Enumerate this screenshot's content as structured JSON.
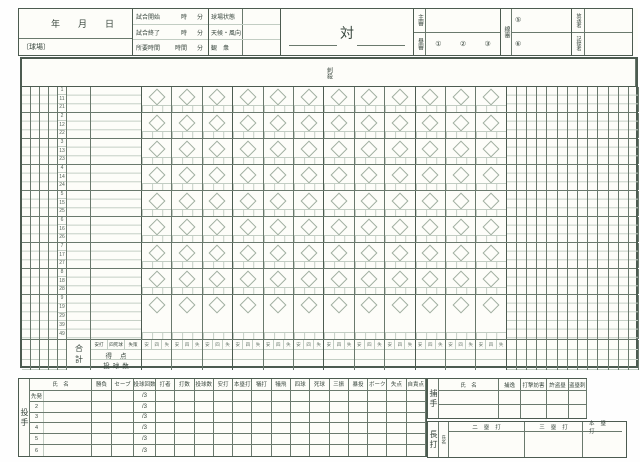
{
  "colors": {
    "line": "#6a796d",
    "line_heavy": "#4c5b50",
    "line_light": "#c2cdc3",
    "text": "#39473e",
    "paper": "#fdfdf9"
  },
  "header": {
    "date": {
      "year": "年",
      "month": "月",
      "day": "日"
    },
    "stadium_label": "〔球場〕",
    "time_rows": [
      {
        "label": "試合開始",
        "u1": "時",
        "u2": "分"
      },
      {
        "label": "試合終了",
        "u1": "時",
        "u2": "分"
      },
      {
        "label": "所要時間",
        "u1": "時間",
        "u2": "分"
      }
    ],
    "condition_rows": [
      {
        "label": "球場状態"
      },
      {
        "label": "天候・風向"
      },
      {
        "label": "観　衆"
      }
    ],
    "vs": "対",
    "umpires": {
      "chief_label": "主審",
      "base_label": "塁審",
      "base_nums": [
        "①",
        "②",
        "③"
      ],
      "line_label": "線審",
      "line_nums": [
        "⑤",
        "⑥"
      ]
    },
    "recorders": [
      {
        "label": "放送者"
      },
      {
        "label": "記録者"
      }
    ]
  },
  "grid": {
    "left_headers": [
      "刺殺",
      "補殺",
      "失策",
      "併殺",
      "打順"
    ],
    "seat_header": "シート",
    "first_attack": [
      "先",
      "攻"
    ],
    "innings": [
      "1",
      "2",
      "3",
      "4",
      "5",
      "6",
      "7",
      "8",
      "9",
      "10",
      "11",
      "12"
    ],
    "right_headers": [
      "打席数",
      "打数",
      "得点",
      "安打",
      "打点",
      "盗塁",
      "犠打",
      "犠飛",
      "四球",
      "死球",
      "三振",
      "失策",
      "残塁"
    ],
    "slot_numbers": [
      [
        "1",
        "11",
        "21"
      ],
      [
        "2",
        "12",
        "22"
      ],
      [
        "3",
        "13",
        "23"
      ],
      [
        "4",
        "14",
        "24"
      ],
      [
        "5",
        "15",
        "25"
      ],
      [
        "6",
        "16",
        "26"
      ],
      [
        "7",
        "17",
        "27"
      ],
      [
        "8",
        "18",
        "28"
      ],
      [
        "9",
        "19",
        "29",
        "39",
        "49"
      ]
    ],
    "summary": {
      "total_label": "合計",
      "legend": [
        "安打",
        "四死球",
        "失策"
      ],
      "inning_ticks": [
        "安",
        "四",
        "失"
      ],
      "score_label": "得点",
      "pitch_label": "投球数"
    }
  },
  "pitchers": {
    "side_label": "投手",
    "headers": [
      "氏　名",
      "勝負",
      "セーブ",
      "投球回数",
      "打者",
      "打数",
      "投球数",
      "安打",
      "本塁打",
      "犠打",
      "犠飛",
      "四球",
      "死球",
      "三振",
      "暴投",
      "ボーク",
      "失点",
      "自責点"
    ],
    "row_labels": [
      "先発",
      "2",
      "3",
      "4",
      "5",
      "6"
    ],
    "ip_placeholder": "/3"
  },
  "catchers": {
    "side_label": "捕手",
    "headers": [
      "氏　名",
      "捕逸",
      "打撃妨害",
      "許盗塁",
      "盗塁刺"
    ],
    "row_count": 2
  },
  "long_hits": {
    "side_label": "長打",
    "name_label": "氏名",
    "headers": [
      "二塁打",
      "三塁打",
      "本塁打"
    ]
  }
}
